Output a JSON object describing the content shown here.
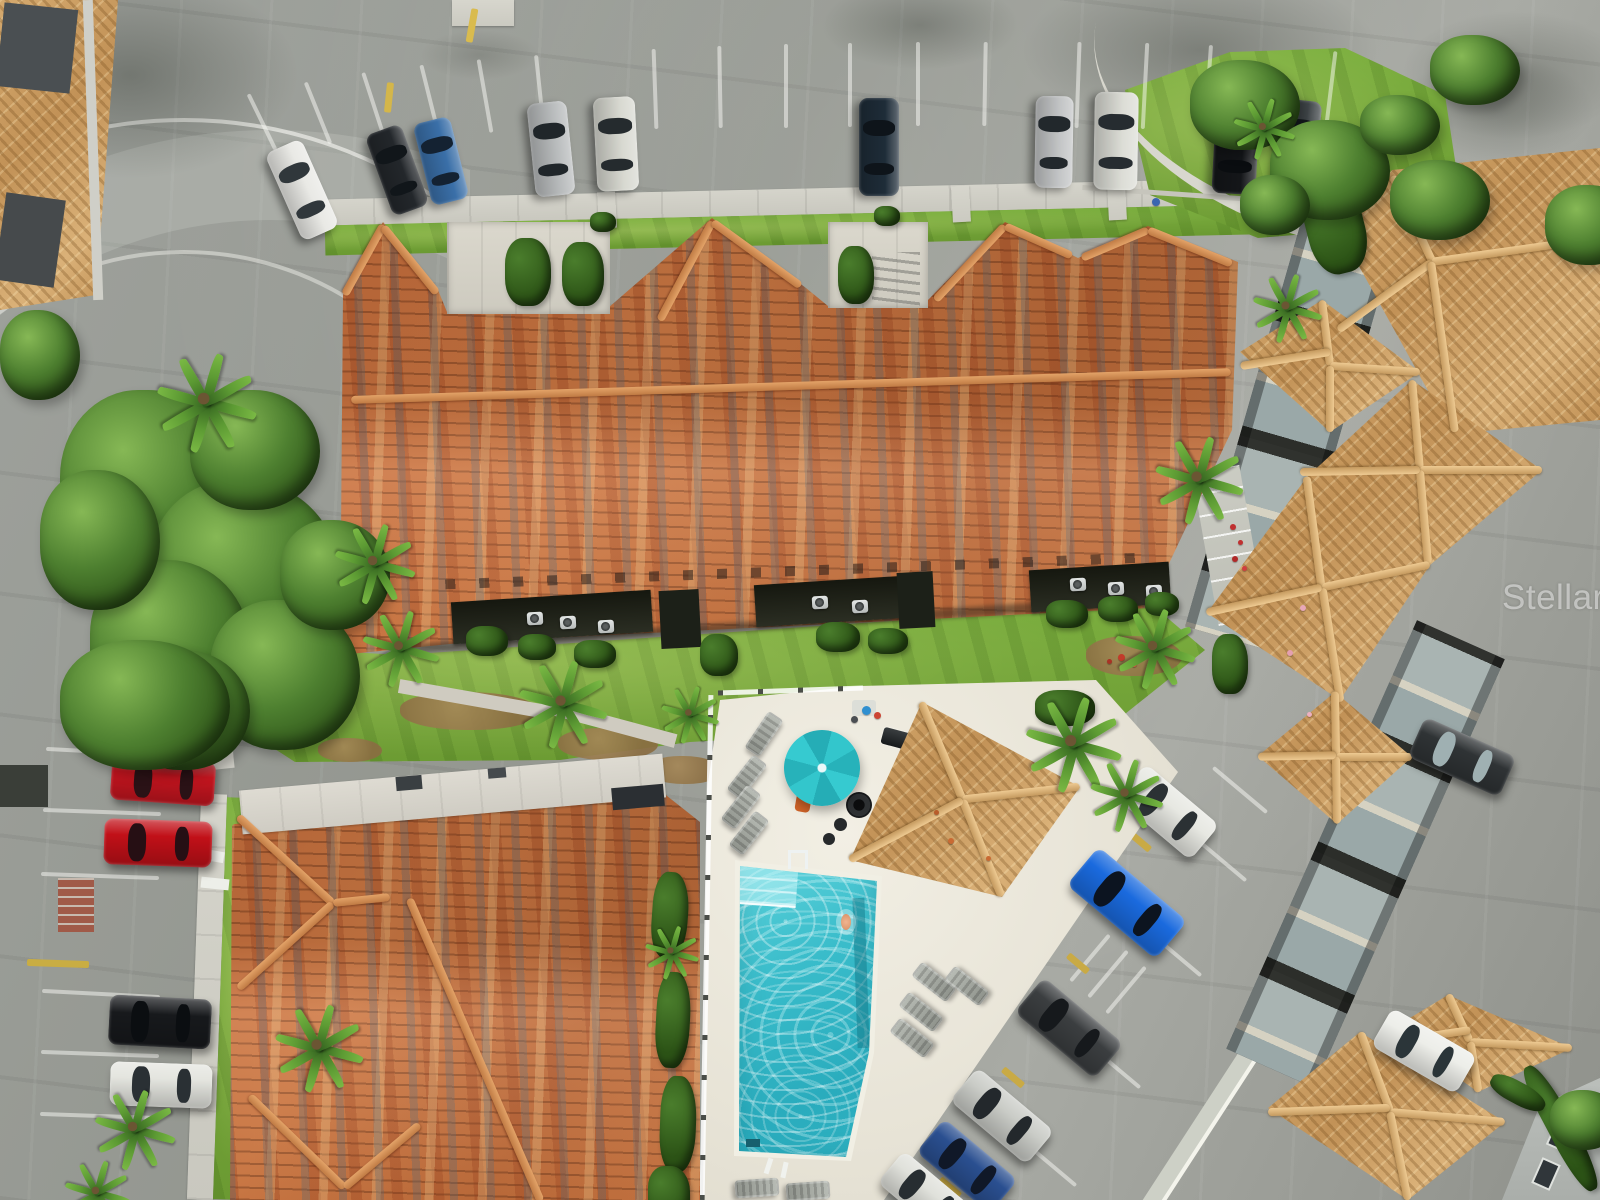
{
  "scene": {
    "title": "Aerial drone view of a Mediterranean-style condominium community with tiled roofs, swimming pool and parking lots",
    "watermark": "StellarMLS"
  },
  "palette": {
    "asphalt": "#9a9d98",
    "roof_terracotta": "#c97440",
    "roof_tan": "#cda267",
    "pool_water": "#35b8c8",
    "pool_deck": "#eae6da",
    "grass": "#7db040",
    "umbrella_teal": "#2ec0c6",
    "stall_white": "rgba(250,250,245,.5)",
    "curb_yellow": "#d1b44a"
  },
  "legend": {
    "shadows": "[x,y,w,h,opacity] soft ground/tree shadows",
    "trees": "[x,y,w,h] canopy blobs",
    "hedges": "[x,y,w,h,rot] shrub rows",
    "mulch": "[x,y,w,h] brown landscape beds",
    "palms": "[x,y,scale] palm trees",
    "ridges": "[cx,cy,len,rot,tone] roof ridge caps (r=terracotta,t=tan)",
    "stalls": "[cx,cy,len,rot,color?] parking stripes / yellow curbs",
    "ac_units": "[x,y] air conditioner condensers",
    "dots": "[x,y,d,color] flowers, people, debris",
    "loungers": "[cx,cy,rot] pool lounge chairs",
    "cars": "[cx,cy,len,wid,rot,body,glass,name] parked vehicles"
  },
  "shadows": [
    [
      -40,
      -30,
      340,
      210,
      0.5
    ],
    [
      820,
      -20,
      200,
      90,
      0.4
    ],
    [
      1020,
      -30,
      360,
      160,
      0.45
    ],
    [
      1400,
      10,
      230,
      130,
      0.4
    ],
    [
      1500,
      150,
      140,
      90,
      0.35
    ],
    [
      240,
      970,
      150,
      60,
      0.25
    ],
    [
      1240,
      120,
      120,
      70,
      0.3
    ],
    [
      420,
      30,
      120,
      50,
      0.25
    ],
    [
      1395,
      55,
      200,
      110,
      0.35
    ],
    [
      830,
      850,
      130,
      60,
      0.2
    ]
  ],
  "trees": [
    [
      60,
      390,
      180,
      200
    ],
    [
      150,
      480,
      190,
      190
    ],
    [
      90,
      560,
      160,
      170
    ],
    [
      190,
      390,
      130,
      120
    ],
    [
      210,
      600,
      150,
      150
    ],
    [
      120,
      650,
      130,
      120
    ],
    [
      40,
      470,
      120,
      140
    ],
    [
      60,
      640,
      170,
      130
    ],
    [
      0,
      310,
      80,
      90
    ],
    [
      280,
      520,
      110,
      110
    ],
    [
      1190,
      60,
      110,
      90
    ],
    [
      1270,
      120,
      120,
      100
    ],
    [
      1390,
      160,
      100,
      80
    ],
    [
      1430,
      35,
      90,
      70
    ],
    [
      1545,
      185,
      90,
      80
    ],
    [
      1360,
      95,
      80,
      60
    ],
    [
      1550,
      1090,
      70,
      60
    ],
    [
      1240,
      175,
      70,
      60
    ]
  ],
  "hedges": [
    [
      505,
      238,
      46,
      68,
      0
    ],
    [
      562,
      242,
      42,
      64,
      0
    ],
    [
      838,
      246,
      36,
      58,
      0
    ],
    [
      1306,
      178,
      58,
      96,
      -14
    ],
    [
      466,
      626,
      42,
      30,
      0
    ],
    [
      518,
      634,
      38,
      26,
      0
    ],
    [
      574,
      640,
      42,
      28,
      0
    ],
    [
      816,
      622,
      44,
      30,
      0
    ],
    [
      868,
      628,
      40,
      26,
      0
    ],
    [
      1046,
      600,
      42,
      28,
      0
    ],
    [
      1098,
      596,
      40,
      26,
      0
    ],
    [
      1145,
      592,
      34,
      24,
      0
    ],
    [
      652,
      872,
      36,
      86,
      4
    ],
    [
      656,
      972,
      34,
      96,
      3
    ],
    [
      660,
      1076,
      36,
      96,
      2
    ],
    [
      648,
      1166,
      42,
      56,
      0
    ],
    [
      1548,
      1058,
      26,
      140,
      -28
    ],
    [
      1488,
      1082,
      60,
      22,
      28
    ],
    [
      1212,
      634,
      36,
      60,
      0
    ],
    [
      1035,
      690,
      60,
      36,
      0
    ],
    [
      590,
      212,
      26,
      20,
      0
    ],
    [
      874,
      206,
      26,
      20,
      0
    ],
    [
      700,
      634,
      38,
      42,
      0
    ]
  ],
  "mulch": [
    [
      400,
      692,
      140,
      38
    ],
    [
      558,
      728,
      100,
      32
    ],
    [
      648,
      756,
      74,
      28
    ],
    [
      240,
      700,
      66,
      26
    ],
    [
      318,
      738,
      64,
      24
    ],
    [
      1086,
      636,
      96,
      40
    ]
  ],
  "palms": [
    [
      203,
      398,
      1.3
    ],
    [
      372,
      560,
      1.05
    ],
    [
      398,
      645,
      1.0
    ],
    [
      560,
      700,
      1.15
    ],
    [
      688,
      712,
      0.75
    ],
    [
      1196,
      476,
      1.15
    ],
    [
      1152,
      645,
      1.05
    ],
    [
      1070,
      740,
      1.25
    ],
    [
      1124,
      792,
      0.95
    ],
    [
      316,
      1044,
      1.15
    ],
    [
      132,
      1126,
      1.05
    ],
    [
      95,
      1190,
      0.85
    ],
    [
      1262,
      126,
      0.8
    ],
    [
      670,
      950,
      0.7
    ],
    [
      1285,
      305,
      0.9
    ]
  ],
  "ridges": [
    [
      791,
      386,
      880,
      -1.8,
      "r"
    ],
    [
      364,
      260,
      80,
      119,
      "r"
    ],
    [
      410,
      260,
      86,
      51,
      "r"
    ],
    [
      686,
      271,
      112,
      118,
      "r"
    ],
    [
      756,
      254,
      109,
      36,
      "r"
    ],
    [
      970,
      263,
      102,
      133,
      "r"
    ],
    [
      1038,
      241,
      73,
      24,
      "r"
    ],
    [
      1115,
      244,
      72,
      157,
      "r"
    ],
    [
      1190,
      247,
      90,
      22,
      "r"
    ],
    [
      285,
      860,
      129,
      42.5,
      "r"
    ],
    [
      285,
      946,
      127,
      -42,
      "r"
    ],
    [
      361,
      900,
      57,
      -6,
      "r"
    ],
    [
      475,
      1050,
      330,
      66.5,
      "r"
    ],
    [
      297,
      1142,
      132,
      44,
      "r"
    ],
    [
      382,
      1156,
      98,
      -40,
      "r"
    ],
    [
      942,
      751,
      106,
      67,
      "t"
    ],
    [
      1021,
      793,
      118,
      -6.3,
      "t"
    ],
    [
      982,
      848,
      104,
      68,
      "t"
    ],
    [
      906,
      830,
      128,
      152,
      "t"
    ],
    [
      1412,
      219,
      95,
      65,
      "t"
    ],
    [
      1516,
      250,
      170,
      -8,
      "t"
    ],
    [
      1385,
      296,
      116,
      144,
      "t"
    ],
    [
      1443,
      347,
      172,
      82,
      "t"
    ],
    [
      1326,
      333,
      66,
      83,
      "t"
    ],
    [
      1375,
      369,
      90,
      4,
      "t"
    ],
    [
      1285,
      359,
      91,
      171,
      "t"
    ],
    [
      1330,
      399,
      66,
      90,
      "t"
    ],
    [
      1416,
      425,
      90,
      85,
      "t"
    ],
    [
      1481,
      470,
      122,
      0,
      "t"
    ],
    [
      1424,
      517,
      94,
      85,
      "t"
    ],
    [
      1360,
      471,
      120,
      179,
      "t"
    ],
    [
      1314,
      532,
      112,
      82.3,
      "t"
    ],
    [
      1376,
      576,
      110,
      -12,
      "t"
    ],
    [
      1331,
      645,
      115,
      81,
      "t"
    ],
    [
      1264,
      600,
      118,
      167.7,
      "t"
    ],
    [
      1335,
      724,
      65,
      89,
      "t"
    ],
    [
      1374,
      757,
      76,
      0,
      "t"
    ],
    [
      1336,
      790,
      67,
      89,
      "t"
    ],
    [
      1297,
      756,
      78,
      179,
      "t"
    ],
    [
      1459,
      1018,
      52,
      65,
      "t"
    ],
    [
      1521,
      1045,
      102,
      3.4,
      "t"
    ],
    [
      1474,
      1067,
      51,
      81,
      "t"
    ],
    [
      1430,
      1036,
      81,
      -8.5,
      "t"
    ],
    [
      1375,
      1072,
      85,
      69.4,
      "t"
    ],
    [
      1447,
      1117,
      115,
      5,
      "t"
    ],
    [
      1399,
      1156,
      90,
      78.4,
      "t"
    ],
    [
      1329,
      1110,
      122,
      -2,
      "t"
    ]
  ],
  "stalls": [
    [
      262,
      122,
      62,
      64
    ],
    [
      318,
      113,
      66,
      68
    ],
    [
      374,
      106,
      70,
      72
    ],
    [
      430,
      100,
      72,
      76
    ],
    [
      485,
      96,
      74,
      80
    ],
    [
      540,
      93,
      76,
      84
    ],
    [
      655,
      89,
      80,
      88
    ],
    [
      720,
      87,
      82,
      89
    ],
    [
      786,
      86,
      84,
      90
    ],
    [
      850,
      85,
      84,
      90
    ],
    [
      918,
      84,
      84,
      90
    ],
    [
      985,
      84,
      84,
      91
    ],
    [
      1078,
      85,
      86,
      92
    ],
    [
      1145,
      86,
      86,
      93
    ],
    [
      1208,
      88,
      86,
      94
    ],
    [
      1330,
      96,
      90,
      97
    ],
    [
      1213,
      853,
      86,
      40
    ],
    [
      1168,
      948,
      86,
      40
    ],
    [
      1107,
      1060,
      86,
      40
    ],
    [
      1043,
      1158,
      86,
      40
    ],
    [
      1240,
      790,
      70,
      40
    ],
    [
      1108,
      974,
      60,
      -50
    ],
    [
      1126,
      990,
      60,
      -50
    ],
    [
      1090,
      958,
      60,
      -50
    ],
    [
      105,
      752,
      118,
      3
    ],
    [
      102,
      812,
      118,
      2
    ],
    [
      100,
      876,
      118,
      2
    ],
    [
      101,
      994,
      118,
      3
    ],
    [
      100,
      1054,
      118,
      2
    ],
    [
      99,
      1116,
      118,
      2
    ],
    [
      472,
      24,
      34,
      100,
      "#d9bb4e"
    ],
    [
      389,
      96,
      30,
      96,
      "#d4b64a"
    ],
    [
      58,
      962,
      62,
      2,
      "#c9ad43"
    ],
    [
      1500,
      310,
      32,
      10,
      "#d9c050"
    ],
    [
      1566,
      322,
      32,
      10,
      "#d9c050"
    ],
    [
      1140,
      840,
      26,
      40,
      "#c9aa45"
    ],
    [
      1078,
      962,
      26,
      40,
      "#c9aa45"
    ],
    [
      1013,
      1076,
      26,
      40,
      "#c9aa45"
    ],
    [
      950,
      1186,
      26,
      40,
      "#c9aa45"
    ]
  ],
  "ac_units": [
    [
      527,
      612
    ],
    [
      560,
      616
    ],
    [
      598,
      620
    ],
    [
      812,
      596
    ],
    [
      852,
      600
    ],
    [
      1070,
      578
    ],
    [
      1108,
      582
    ],
    [
      1146,
      585
    ]
  ],
  "dots": [
    [
      1230,
      524,
      6,
      "#c03030"
    ],
    [
      1238,
      540,
      5,
      "#c03030"
    ],
    [
      1232,
      556,
      6,
      "#b02828"
    ],
    [
      1242,
      566,
      5,
      "#d04040"
    ],
    [
      1118,
      654,
      7,
      "#c23b2a"
    ],
    [
      1131,
      661,
      6,
      "#e05540"
    ],
    [
      1107,
      659,
      5,
      "#a93325"
    ],
    [
      1300,
      605,
      6,
      "#e8a8b8"
    ],
    [
      1287,
      650,
      6,
      "#e5a0b0"
    ],
    [
      1307,
      712,
      5,
      "#eeb0c0"
    ],
    [
      862,
      706,
      9,
      "#2f8fd0"
    ],
    [
      874,
      712,
      7,
      "#cc4433"
    ],
    [
      851,
      716,
      7,
      "#4a4e52"
    ],
    [
      948,
      838,
      6,
      "#c96a33"
    ],
    [
      986,
      856,
      5,
      "#c96a33"
    ],
    [
      934,
      810,
      5,
      "#b85c2a"
    ],
    [
      1152,
      198,
      8,
      "#3a66b0"
    ]
  ],
  "loungers": [
    [
      764,
      734,
      34
    ],
    [
      747,
      777,
      38
    ],
    [
      741,
      807,
      38
    ],
    [
      749,
      833,
      38
    ],
    [
      934,
      982,
      -52
    ],
    [
      967,
      986,
      -52
    ],
    [
      921,
      1012,
      -52
    ],
    [
      912,
      1038,
      -52
    ],
    [
      757,
      1188,
      86
    ],
    [
      808,
      1191,
      86
    ]
  ],
  "cars": [
    [
      302,
      190,
      96,
      40,
      66,
      "#e9e9e5",
      "#30373b",
      "white-van"
    ],
    [
      397,
      170,
      86,
      38,
      70,
      "#23272b",
      "#11161a",
      "black-car"
    ],
    [
      441,
      161,
      84,
      38,
      76,
      "#3a6fa8",
      "#142232",
      "blue-car"
    ],
    [
      551,
      149,
      94,
      40,
      84,
      "#b9bcbd",
      "#20262a",
      "silver-suv"
    ],
    [
      616,
      144,
      94,
      42,
      87,
      "#d8d9d1",
      "#252b2e",
      "white-suv"
    ],
    [
      879,
      147,
      98,
      40,
      90,
      "#1e2c38",
      "#0e141a",
      "navy-car"
    ],
    [
      1054,
      142,
      92,
      38,
      91,
      "#c3c5c6",
      "#22282c",
      "silver-car"
    ],
    [
      1116,
      141,
      98,
      44,
      91,
      "#dcddd6",
      "#262c30",
      "white-suv"
    ],
    [
      1236,
      144,
      100,
      44,
      93,
      "#141619",
      "#0a0d10",
      "black-minivan"
    ],
    [
      1298,
      144,
      88,
      40,
      96,
      "#3f4548",
      "#14191d",
      "gray-car"
    ],
    [
      138,
      720,
      70,
      34,
      3,
      "#7c1620",
      "#1a1016",
      "maroon-car"
    ],
    [
      163,
      781,
      104,
      44,
      4,
      "#c5151f",
      "#2a1216",
      "red-car"
    ],
    [
      158,
      843,
      108,
      46,
      2,
      "#c11018",
      "#260f14",
      "red-car"
    ],
    [
      160,
      1022,
      102,
      50,
      3,
      "#17191c",
      "#0b0e11",
      "black-suv"
    ],
    [
      161,
      1085,
      102,
      44,
      2,
      "#e4e5df",
      "#2a3034",
      "white-car"
    ],
    [
      1168,
      812,
      96,
      46,
      40,
      "#e7e8e2",
      "#2b3134",
      "white-suv"
    ],
    [
      1127,
      903,
      116,
      50,
      40,
      "#1a6ade",
      "#0c1420",
      "blue-truck"
    ],
    [
      1069,
      1028,
      104,
      46,
      40,
      "#3b3e40",
      "#16191c",
      "gray-car"
    ],
    [
      1002,
      1116,
      100,
      44,
      40,
      "#caccc7",
      "#23282c",
      "silver-car"
    ],
    [
      967,
      1166,
      96,
      44,
      40,
      "#2a4f90",
      "#101828",
      "blue-car"
    ],
    [
      926,
      1196,
      92,
      42,
      40,
      "#e0e1db",
      "#272d31",
      "white-car"
    ],
    [
      1462,
      757,
      100,
      44,
      24,
      "#2f3335",
      "#9fb0b2",
      "dark-car"
    ],
    [
      1424,
      1051,
      98,
      44,
      30,
      "#edeee9",
      "#2b3539",
      "white-car"
    ]
  ]
}
